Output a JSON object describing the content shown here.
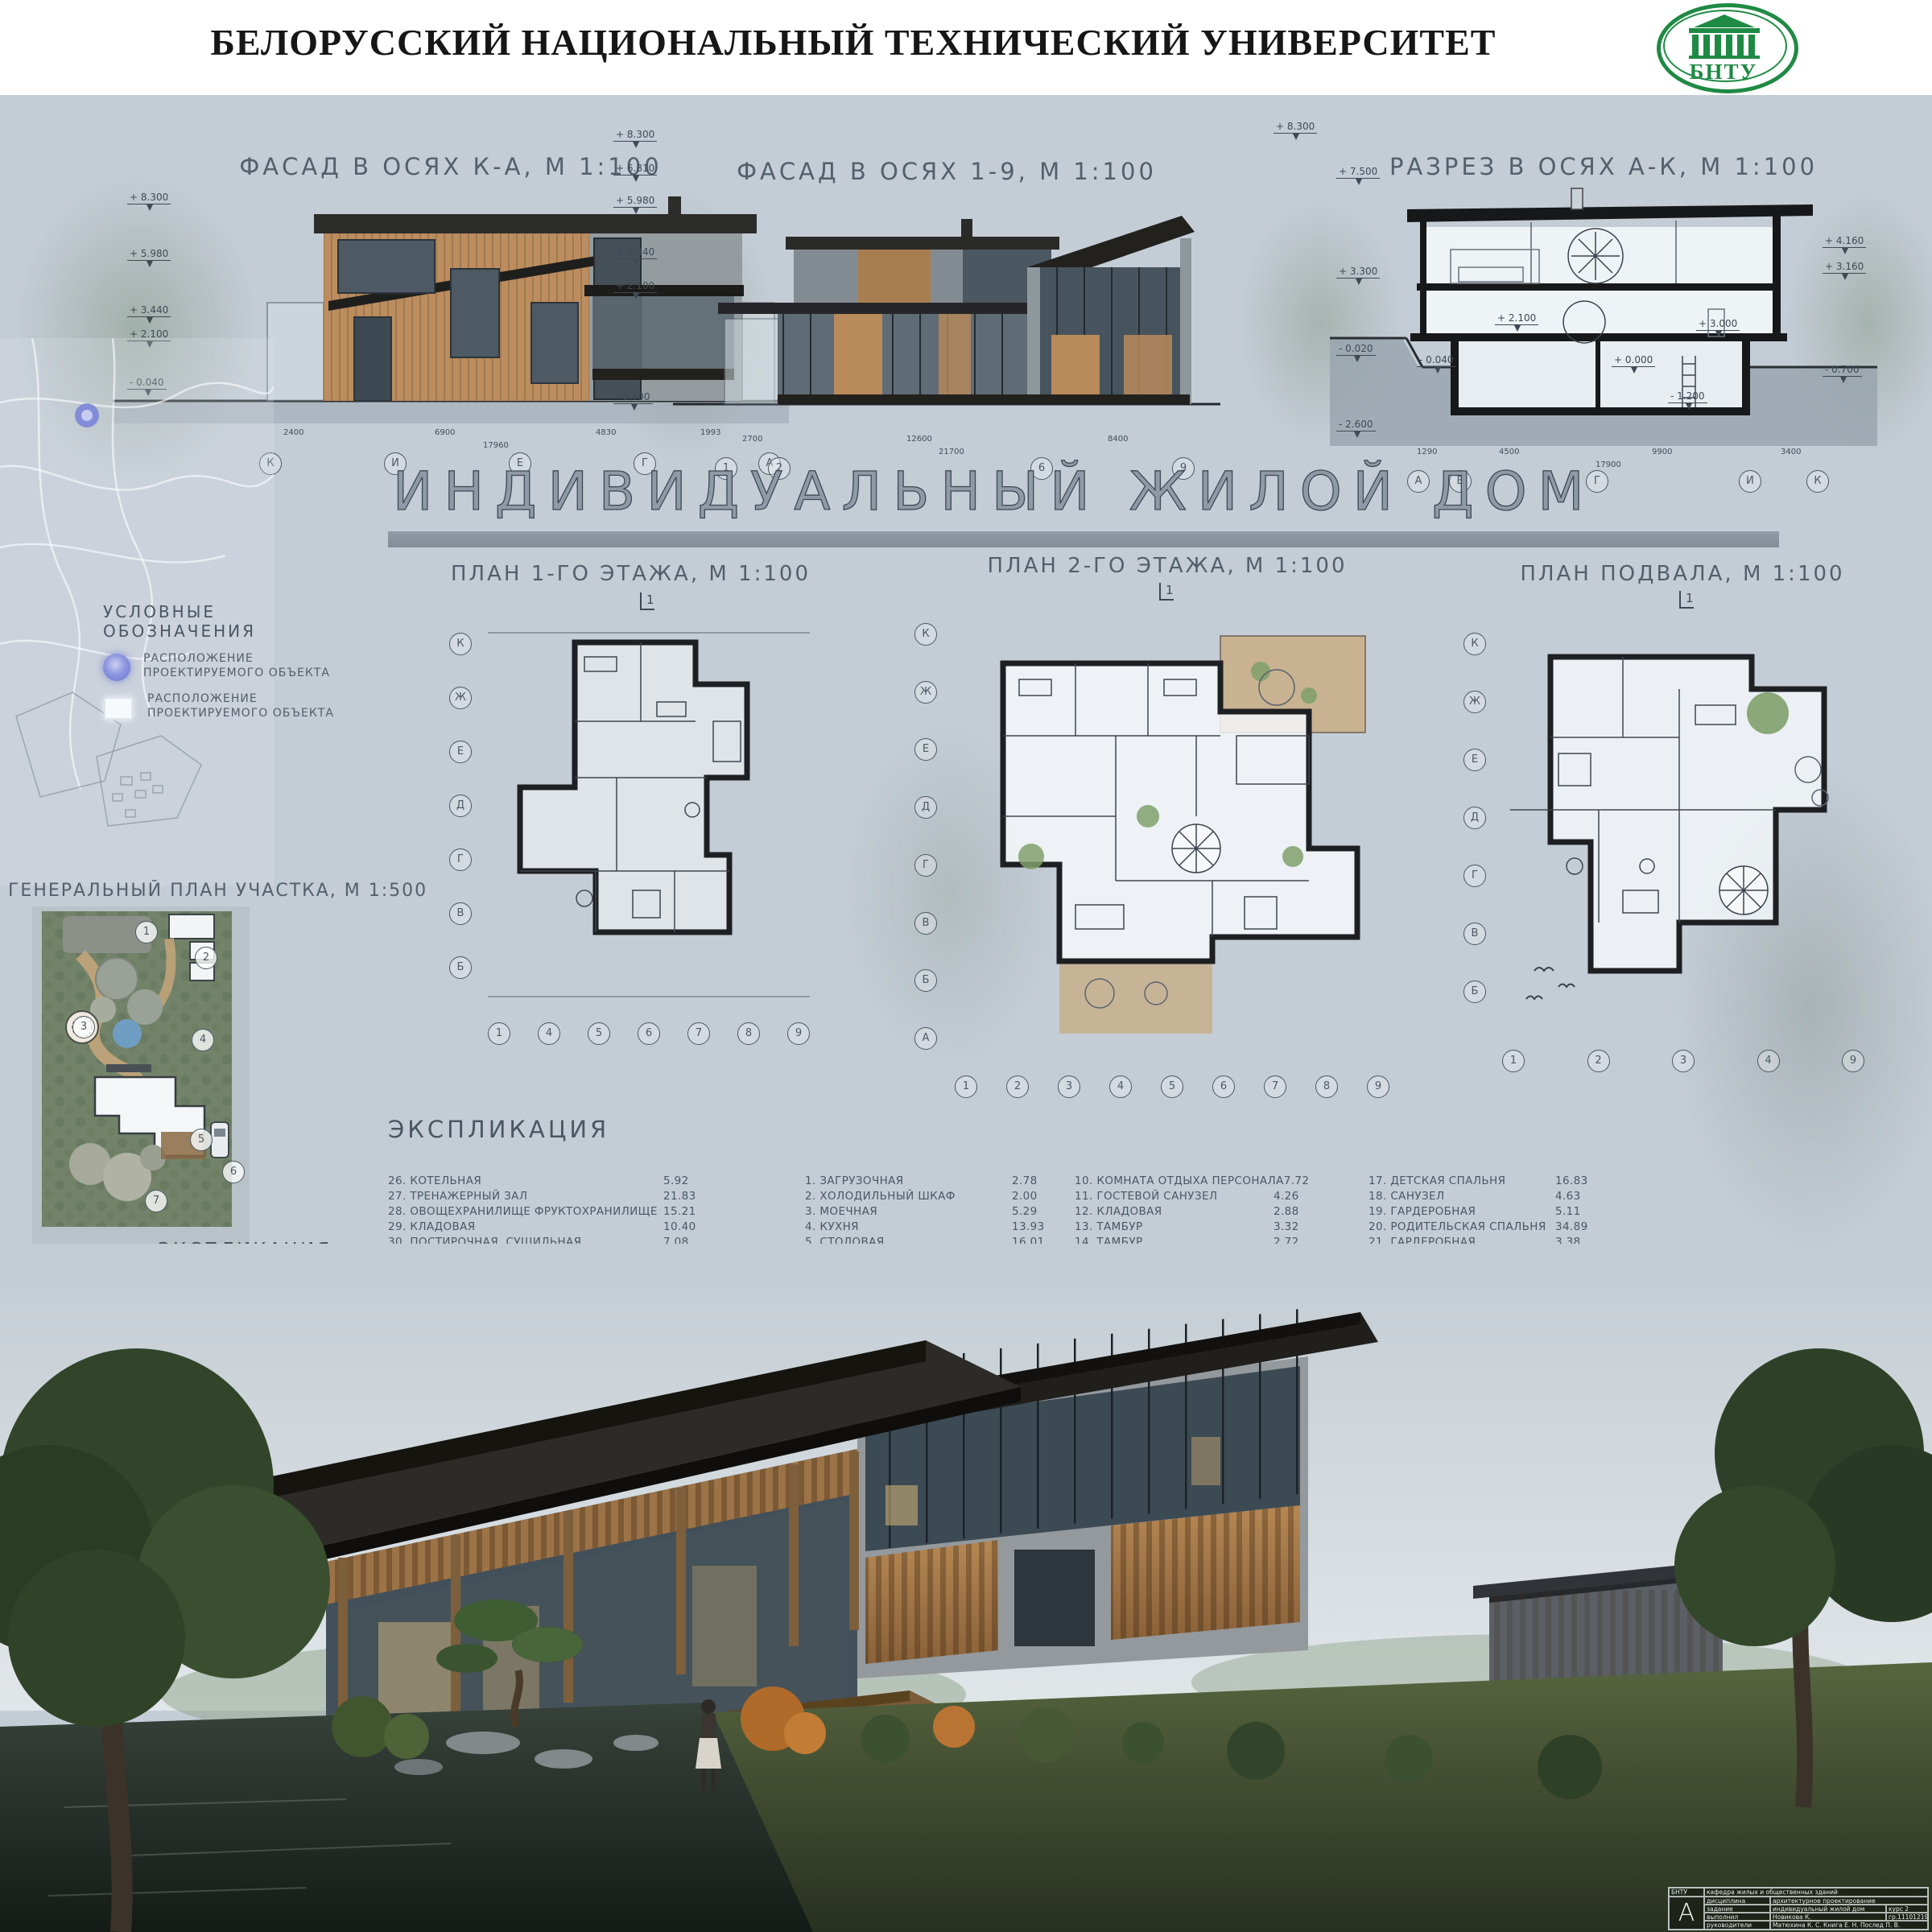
{
  "header": {
    "title": "БЕЛОРУССКИЙ НАЦИОНАЛЬНЫЙ ТЕХНИЧЕСКИЙ УНИВЕРСИТЕТ",
    "logo_text": "БНТУ",
    "logo_color": "#1f8a44"
  },
  "main_title": "ИНДИВИДУАЛЬНЫЙ ЖИЛОЙ ДОМ",
  "top_drawings": {
    "facade_ka": {
      "title": "ФАСАД В ОСЯХ К-А, М 1:100",
      "marks": [
        "+ 8.300",
        "+ 5.980",
        "+ 3.440",
        "+ 2.100",
        "- 0.040"
      ],
      "axes": [
        "К",
        "И",
        "Е",
        "Г",
        "А"
      ],
      "dims": [
        "2400",
        "6900",
        "4830",
        "1993"
      ],
      "total_dim": "17960"
    },
    "facade_19": {
      "title": "ФАСАД В ОСЯХ 1-9, М 1:100",
      "marks": [
        "+ 8.300",
        "+ 6.810",
        "+ 5.980",
        "+ 3.440",
        "+ 2.100",
        "- 0.700"
      ],
      "axes": [
        "1",
        "2",
        "6",
        "9"
      ],
      "dims": [
        "2700",
        "12600",
        "8400"
      ],
      "total_dim": "21700"
    },
    "section_ak": {
      "title": "РАЗРЕЗ В ОСЯХ А-К, М 1:100",
      "marks_left": [
        "+ 8.300",
        "+ 7.500",
        "+ 3.300",
        "- 0.020",
        "- 2.600"
      ],
      "marks_inner": [
        "+ 2.100",
        "+ 0.000",
        "+ 3.000",
        "- 1.200",
        "- 0.040"
      ],
      "marks_right": [
        "+ 4.160",
        "+ 3.160",
        "- 0.700"
      ],
      "axes": [
        "А",
        "Б",
        "Г",
        "И",
        "К"
      ],
      "dims": [
        "1290",
        "4500",
        "9900",
        "3400"
      ],
      "total_dim": "17900"
    }
  },
  "plans": {
    "cut_label": "1",
    "floor1": {
      "title": "ПЛАН 1-ГО ЭТАЖА, М 1:100",
      "axes_left": [
        "К",
        "Ж",
        "Е",
        "Д",
        "Г",
        "В",
        "Б"
      ],
      "axes_bottom": [
        "1",
        "4",
        "5",
        "6",
        "7",
        "8",
        "9"
      ]
    },
    "floor2": {
      "title": "ПЛАН 2-ГО ЭТАЖА, М 1:100",
      "axes_left": [
        "К",
        "Ж",
        "Е",
        "Д",
        "Г",
        "В",
        "Б",
        "А"
      ],
      "axes_bottom": [
        "1",
        "2",
        "3",
        "4",
        "5",
        "6",
        "7",
        "8",
        "9"
      ]
    },
    "basement": {
      "title": "ПЛАН ПОДВАЛА, М 1:100",
      "axes_left": [
        "К",
        "Ж",
        "Е",
        "Д",
        "Г",
        "В",
        "Б"
      ],
      "axes_bottom": [
        "1",
        "2",
        "3",
        "4",
        "9"
      ]
    }
  },
  "legend": {
    "title": "УСЛОВНЫЕ ОБОЗНАЧЕНИЯ",
    "items": [
      {
        "symbol": "location-dot",
        "label": "РАСПОЛОЖЕНИЕ\nПРОЕКТИРУЕМОГО ОБЪЕКТА"
      },
      {
        "symbol": "location-square",
        "label": "РАСПОЛОЖЕНИЕ\nПРОЕКТИРУЕМОГО ОБЪЕКТА"
      }
    ]
  },
  "site_plan": {
    "title": "ГЕНЕРАЛЬНЫЙ ПЛАН УЧАСТКА, М 1:500",
    "markers": [
      "1",
      "2",
      "3",
      "4",
      "5",
      "6",
      "7"
    ]
  },
  "site_explication": {
    "title": "ЭКСПЛИКАЦИЯ\nУЧАСТКА",
    "items": [
      "1. ОГОРОД",
      "2. БАНЯ,\nХОЗ. ПОСТРОЙКИ",
      "3. ЧАЙНЫЙ ДОМИК",
      "4. ЗЕЛЕНЫЕ\nНАСАЖДЕНИЯ",
      "5. ЖИЛОЙ ДОМ",
      "6. ГАРАЖ",
      "7. САД КАМНЕЙ"
    ]
  },
  "schedule": {
    "title": "ЭКСПЛИКАЦИЯ",
    "col1": [
      {
        "name": "26. КОТЕЛЬНАЯ",
        "area": "5.92"
      },
      {
        "name": "27. ТРЕНАЖЕРНЫЙ ЗАЛ",
        "area": "21.83"
      },
      {
        "name": "28. ОВОЩЕХРАНИЛИЩЕ ФРУКТОХРАНИЛИЩЕ",
        "area": "15.21"
      },
      {
        "name": "29. КЛАДОВАЯ",
        "area": "10.40"
      },
      {
        "name": "30. ПОСТИРОЧНАЯ, СУШИЛЬНАЯ",
        "area": "7.08"
      },
      {
        "name": "31. СОВМЕЩЕННЫЙ САНУЗЕЛ",
        "area": "6.12"
      }
    ],
    "col2": [
      {
        "name": "1. ЗАГРУЗОЧНАЯ",
        "area": "2.78"
      },
      {
        "name": "2. ХОЛОДИЛЬНЫЙ ШКАФ",
        "area": "2.00"
      },
      {
        "name": "3. МОЕЧНАЯ",
        "area": "5.29"
      },
      {
        "name": "4. КУХНЯ",
        "area": "13.93"
      },
      {
        "name": "5. СТОЛОВАЯ",
        "area": "16.01"
      },
      {
        "name": "6. ПРИХОЖАЯ",
        "area": "9.49"
      },
      {
        "name": "7. ОБЩАЯ КОМНАТА",
        "area": "45.74"
      },
      {
        "name": "8. ГАРДЕРОБНАЯ",
        "area": "2.44"
      },
      {
        "name": "9. КЛАДОВАЯ",
        "area": "7.93"
      }
    ],
    "col3": [
      {
        "name": "10. КОМНАТА ОТДЫХА ПЕРСОНАЛА",
        "area": "7.72"
      },
      {
        "name": "11. ГОСТЕВОЙ САНУЗЕЛ",
        "area": "4.26"
      },
      {
        "name": "12. КЛАДОВАЯ",
        "area": "2.88"
      },
      {
        "name": "13. ТАМБУР",
        "area": "3.32"
      },
      {
        "name": "14. ТАМБУР",
        "area": "2.72"
      },
      {
        "name": "15. ПОМЕЩЕНИЕ ДЛЯ ПОСЕТИТЕЛЕЙ",
        "area": "36.48"
      },
      {
        "name": "16. ЗИМНИЙ САД",
        "area": "14.95"
      },
      {
        "name": "25. ГОРЯЧИЙ ЦЕХ",
        "area": "25.73"
      }
    ],
    "col4": [
      {
        "name": "17. ДЕТСКАЯ СПАЛЬНЯ",
        "area": "16.83"
      },
      {
        "name": "18. САНУЗЕЛ",
        "area": "4.63"
      },
      {
        "name": "19. ГАРДЕРОБНАЯ",
        "area": "5.11"
      },
      {
        "name": "20. РОДИТЕЛЬСКАЯ СПАЛЬНЯ",
        "area": "34.89"
      },
      {
        "name": "21. ГАРДЕРОБНАЯ",
        "area": "3.38"
      },
      {
        "name": "22. СОВМЕЩЕННЫЙ САНУЗЕЛ",
        "area": "3.33"
      },
      {
        "name": "23. ГАРДЕРОБНАЯ",
        "area": "3.79"
      },
      {
        "name": "24. ДЕТСКАЯ СПАЛЬНЯ",
        "area": "15.37"
      }
    ]
  },
  "title_block": {
    "org": "БНТУ",
    "dept": "кафедра жилых и общественных зданий",
    "logo_letter": "А",
    "rows": [
      {
        "label": "дисциплина",
        "value": "архитектурное проектирование",
        "extra": ""
      },
      {
        "label": "задание",
        "value": "индивидуальный жилой дом",
        "extra": "курс 2"
      },
      {
        "label": "выполнил",
        "value": "Новикова К.",
        "extra": "гр.11101219"
      },
      {
        "label": "руководители",
        "value": "Матюхина К. С.  Книга Е. Н.  Послед П. В.",
        "extra": ""
      }
    ]
  }
}
